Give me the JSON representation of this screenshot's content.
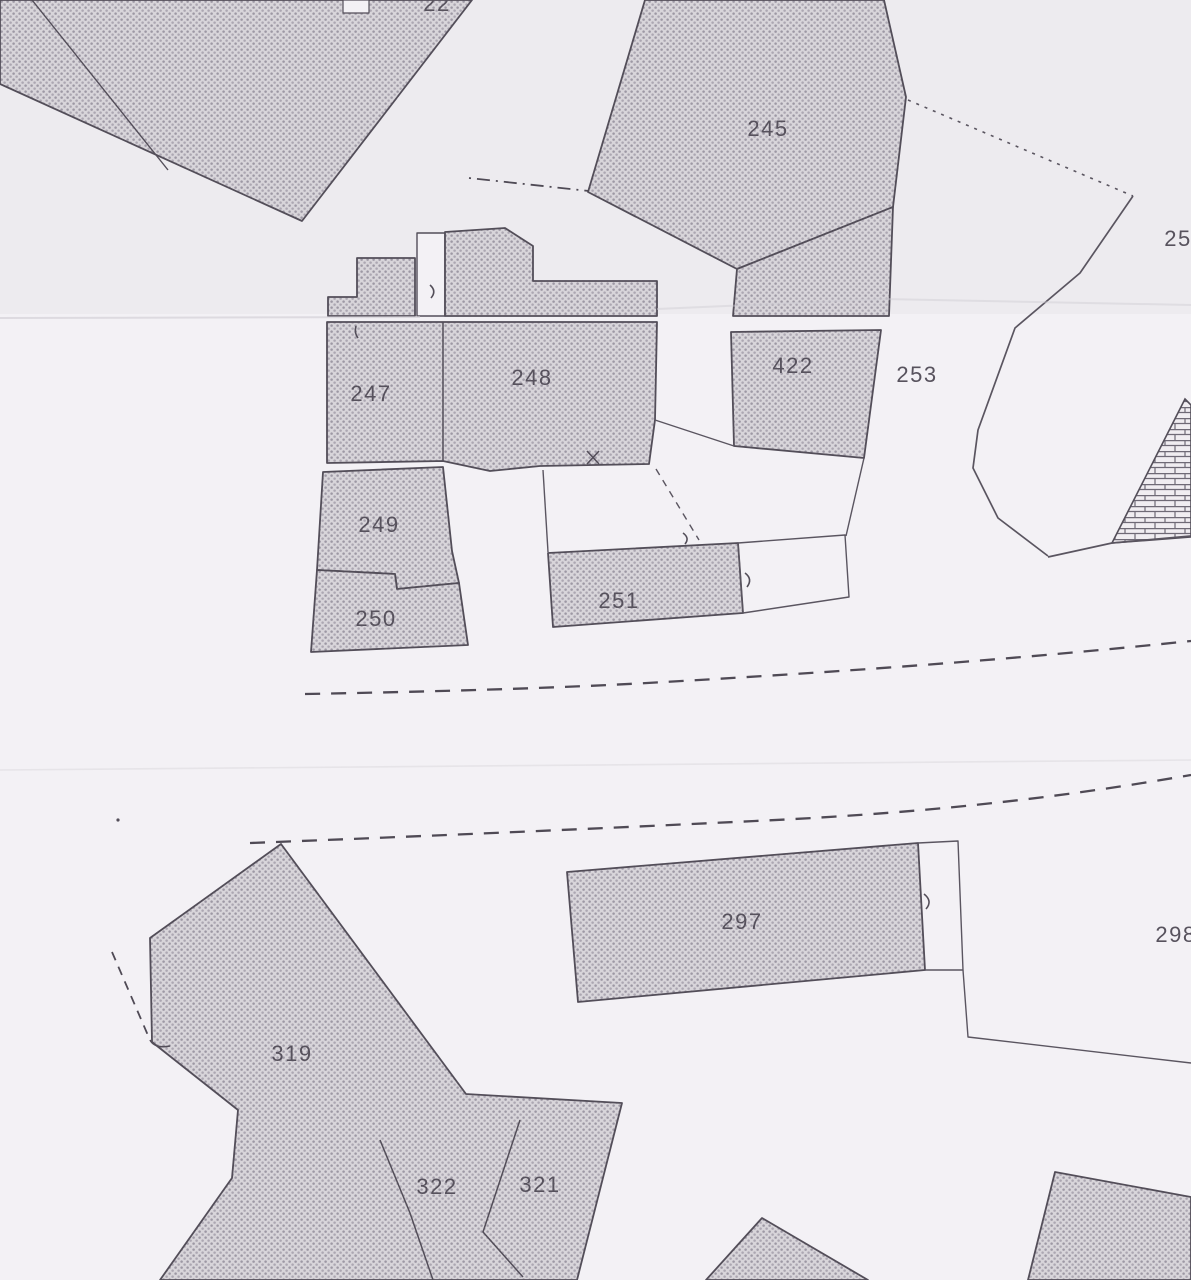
{
  "document": {
    "kind": "scanned cadastral parcel map (two overlapping paper sheets)",
    "seams": "horizontal paper seam near y=318 and faint seam near y=765"
  },
  "colors": {
    "paper_top_sheet": "#edebef",
    "paper_bottom_sheet": "#f3f1f5",
    "ink": "#534e59",
    "hatch_base": "#d8d5da",
    "hatch_dot_a": "#9d98a4",
    "hatch_dot_b": "#aca7b2",
    "label_ink": "#57525d",
    "seam_line": "#d3d0d6",
    "brick_mortar": "#6f6a76"
  },
  "labels": {
    "l22": "22",
    "l245": "245",
    "l247": "247",
    "l248": "248",
    "l422": "422",
    "l253": "253",
    "l249": "249",
    "l250": "250",
    "l251": "251",
    "l25cut": "25",
    "l297": "297",
    "l298": "298",
    "l319": "319",
    "l322": "322",
    "l321": "321"
  },
  "parcels": [
    {
      "number": "22",
      "fill": "hatched",
      "note": "label cut off by top edge"
    },
    {
      "number": "245",
      "fill": "hatched"
    },
    {
      "number": "247",
      "fill": "hatched"
    },
    {
      "number": "248",
      "fill": "hatched"
    },
    {
      "number": "422",
      "fill": "hatched"
    },
    {
      "number": "253",
      "fill": "open"
    },
    {
      "number": "249",
      "fill": "hatched"
    },
    {
      "number": "250",
      "fill": "hatched"
    },
    {
      "number": "251",
      "fill": "hatched"
    },
    {
      "number": "25…",
      "fill": "open",
      "note": "label cut off by right edge"
    },
    {
      "number": "297",
      "fill": "hatched"
    },
    {
      "number": "298",
      "fill": "open",
      "note": "label cut off by right edge"
    },
    {
      "number": "319",
      "fill": "hatched"
    },
    {
      "number": "322",
      "fill": "hatched"
    },
    {
      "number": "321",
      "fill": "hatched"
    }
  ],
  "line_features": [
    {
      "type": "dashed-road-line",
      "count": 2,
      "location": "two long dashed lines crossing the middle of the sheet"
    },
    {
      "type": "dash-dot-boundary",
      "location": "upper centre, running into left corner of parcel 245"
    },
    {
      "type": "dotted-boundary",
      "location": "from right corner of parcel 245 toward right edge"
    },
    {
      "type": "masonry-wall-hatch",
      "location": "brick-hatched triangle at right edge"
    },
    {
      "type": "dashed-offset-line",
      "location": "parallel to upper-left edge of parcel 319"
    }
  ]
}
